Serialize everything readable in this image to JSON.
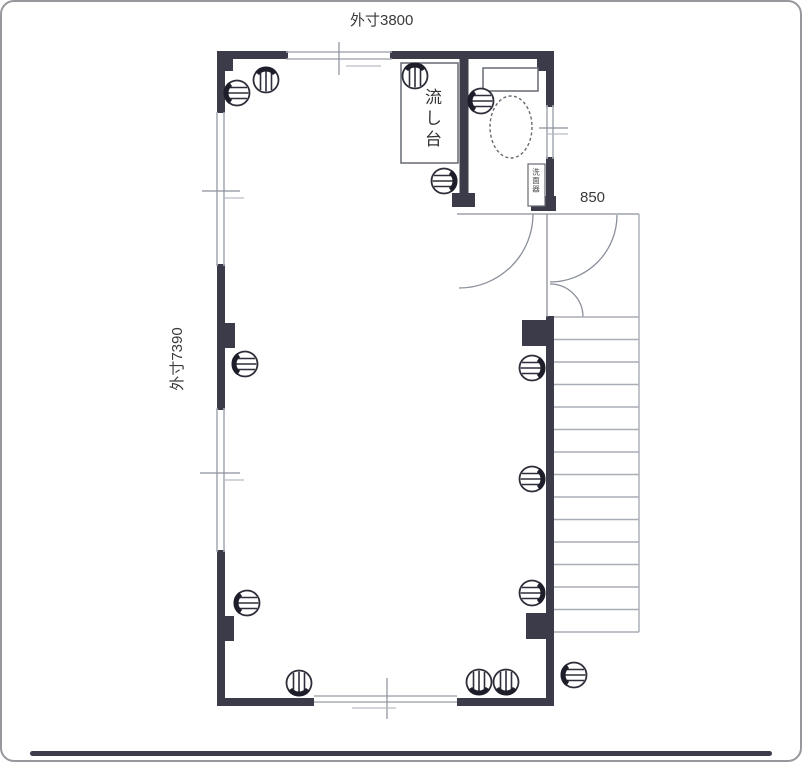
{
  "labels": {
    "dim_top": "外寸3800",
    "dim_left": "外寸7390",
    "dim_entry": "850",
    "sink": "流し台",
    "washbasin": "洗面器"
  },
  "colors": {
    "wall": "#3b3b4a",
    "thin_line": "#8a8f99",
    "window_line": "#a8adb6",
    "symbol_stroke": "#2e2e3a",
    "text": "#3a3a3a"
  },
  "symbols": {
    "outlet": "striped-circle-on-wall"
  },
  "floorplan": {
    "outlets": [
      {
        "x": 235,
        "y": 91,
        "side": "left"
      },
      {
        "x": 264,
        "y": 78,
        "side": "top"
      },
      {
        "x": 413,
        "y": 74,
        "side": "top"
      },
      {
        "x": 442,
        "y": 179,
        "side": "right"
      },
      {
        "x": 479,
        "y": 99,
        "side": "left"
      },
      {
        "x": 243,
        "y": 362,
        "side": "left"
      },
      {
        "x": 245,
        "y": 601,
        "side": "left"
      },
      {
        "x": 530,
        "y": 366,
        "side": "right"
      },
      {
        "x": 530,
        "y": 477,
        "side": "right"
      },
      {
        "x": 530,
        "y": 591,
        "side": "right"
      },
      {
        "x": 572,
        "y": 673,
        "side": "left"
      },
      {
        "x": 297,
        "y": 681,
        "side": "bottom"
      },
      {
        "x": 477,
        "y": 680,
        "side": "bottom"
      },
      {
        "x": 504,
        "y": 680,
        "side": "bottom"
      }
    ],
    "stairs": {
      "left": 552,
      "right": 637,
      "top": 315,
      "bottom": 630,
      "steps": 14
    }
  }
}
